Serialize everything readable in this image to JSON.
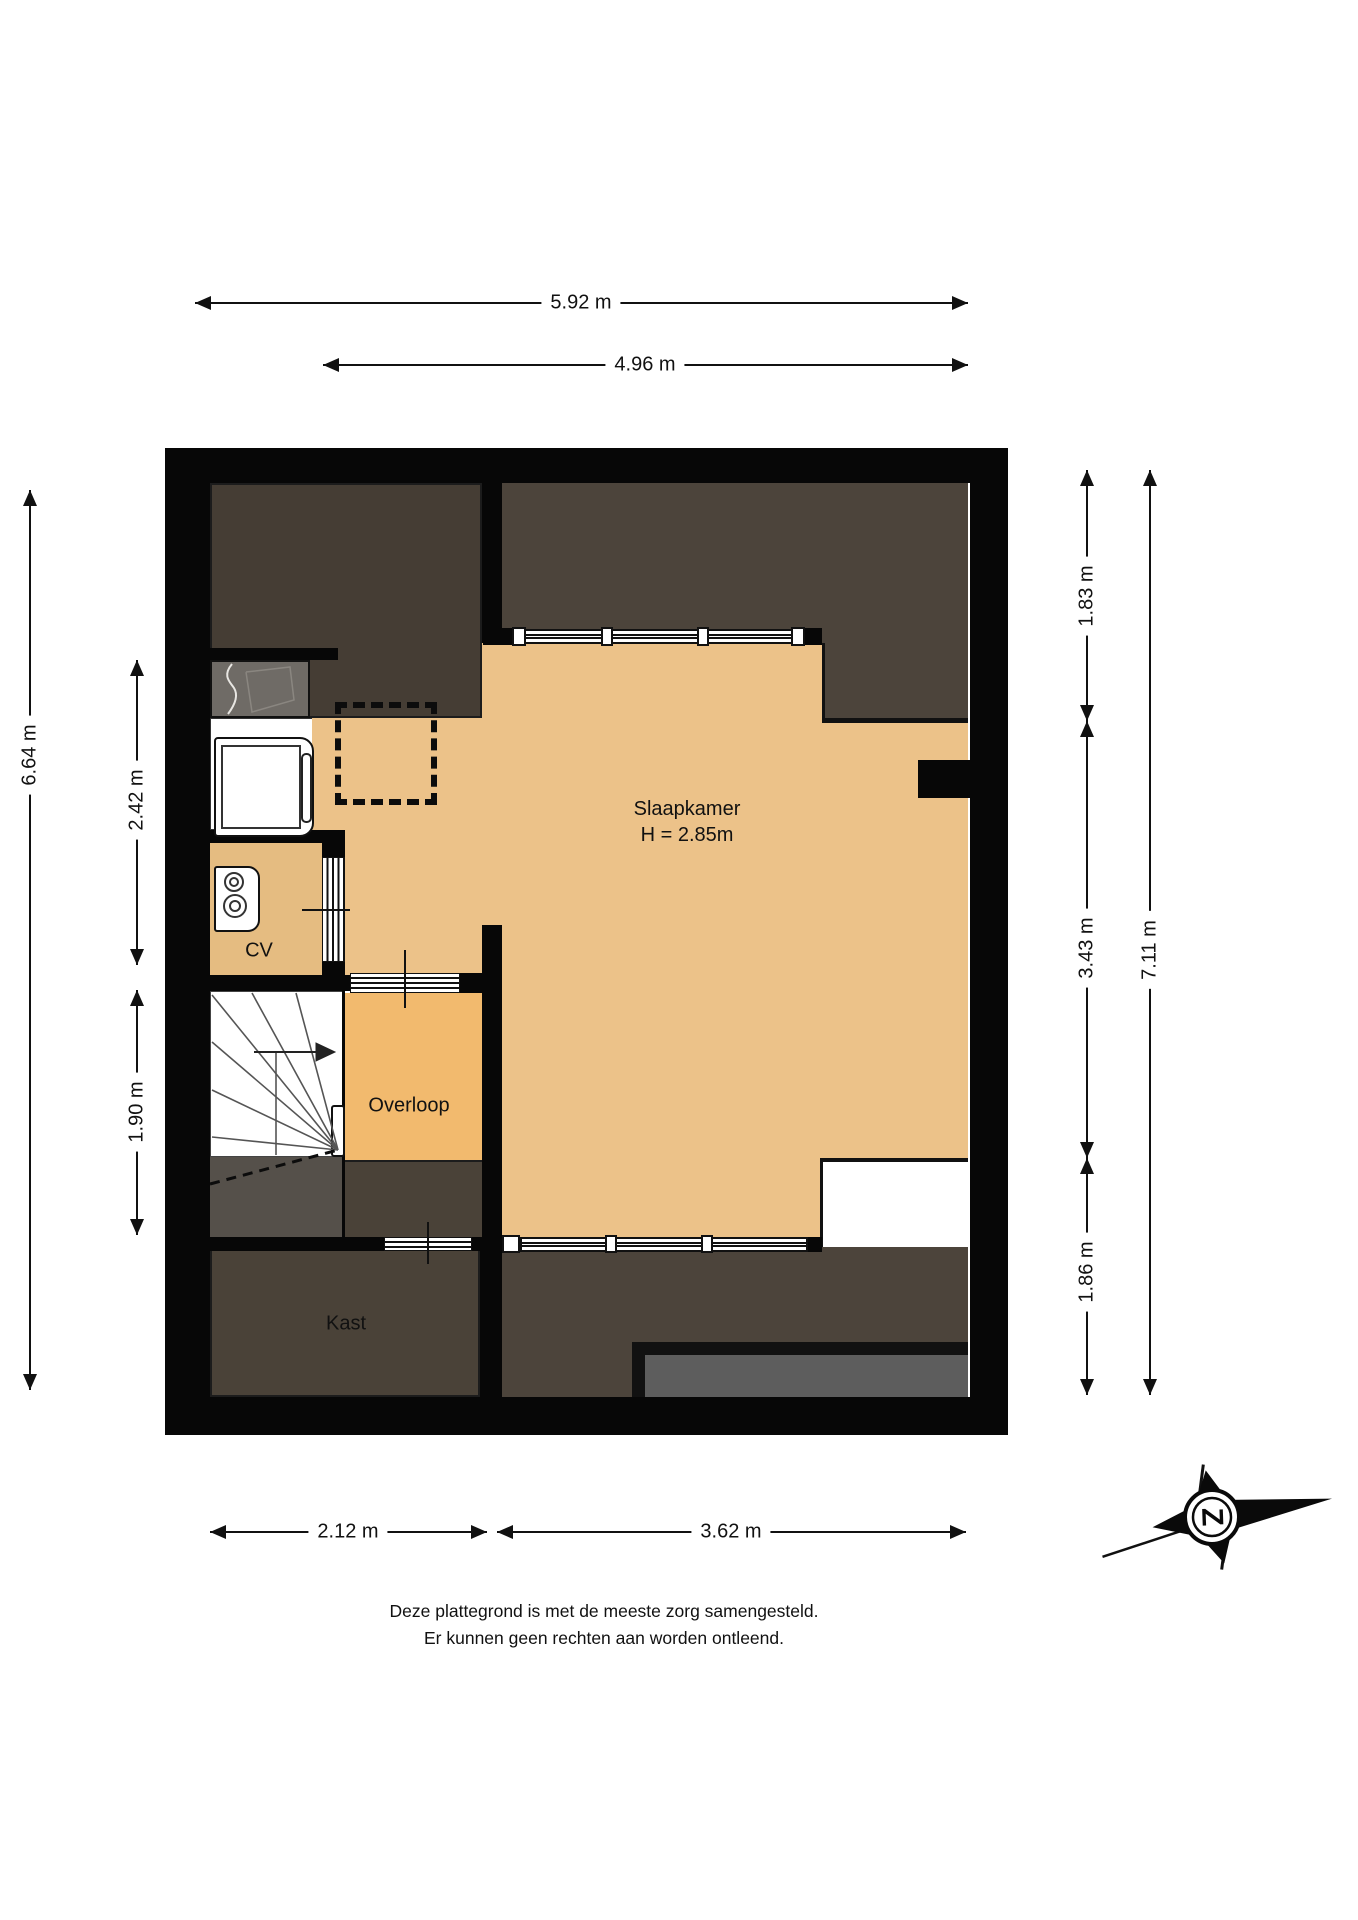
{
  "rooms": {
    "slaapkamer": {
      "label": "Slaapkamer",
      "height": "H = 2.85m"
    },
    "cv": {
      "label": "CV"
    },
    "overloop": {
      "label": "Overloop"
    },
    "kast": {
      "label": "Kast"
    }
  },
  "dimensions": {
    "top_outer": "5.92 m",
    "top_inner": "4.96 m",
    "left_outer": "6.64 m",
    "left_upper": "2.42 m",
    "left_lower": "1.90 m",
    "right_upper": "1.83 m",
    "right_middle": "3.43 m",
    "right_lower": "1.86 m",
    "right_outer": "7.11 m",
    "bottom_left": "2.12 m",
    "bottom_right": "3.62 m"
  },
  "compass": {
    "letter": "Z"
  },
  "footer": {
    "line1": "Deze plattegrond is met de meeste zorg samengesteld.",
    "line2": "Er kunnen geen rechten aan worden ontleend."
  },
  "colors": {
    "wall": "#070707",
    "floor": "#ecc289",
    "floor_overloop": "#f2ba6e",
    "floor_cv": "#e5bc81",
    "slope_dark": "#4c443b",
    "room_dark": "#453d34",
    "kast_dark": "#4a4238",
    "shower_gray": "#6f6b66",
    "landing_gray": "#55504a",
    "balcony_gray": "#5d5d5d"
  }
}
